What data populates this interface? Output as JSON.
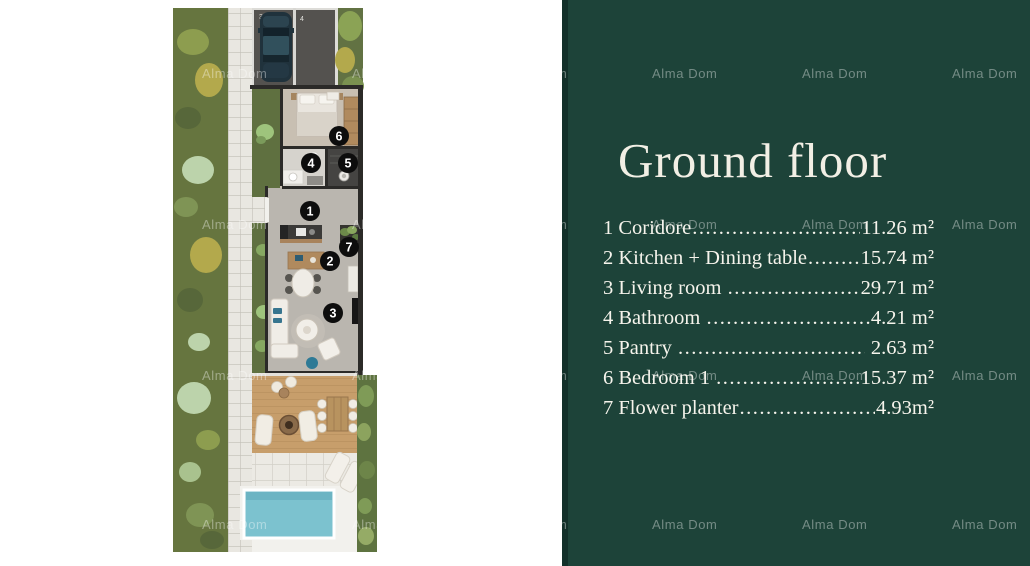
{
  "watermark": {
    "text": "Alma Dom"
  },
  "panel": {
    "title": "Ground floor",
    "leader_dots": "................................................................................",
    "items": [
      {
        "name": "1 Coridore",
        "value": "11.26 m²"
      },
      {
        "name": "2 Kitchen + Dining table",
        "value": "15.74 m²"
      },
      {
        "name": "3 Living room ",
        "value": "29.71 m²"
      },
      {
        "name": "4 Bathroom ",
        "value": "4.21 m²"
      },
      {
        "name": "5 Pantry ",
        "value": " 2.63 m²"
      },
      {
        "name": "6 Bedroom 1 ",
        "value": "15.37 m²"
      },
      {
        "name": "7 Flower planter",
        "value": "4.93m²"
      }
    ],
    "colors": {
      "background": "#1d4339",
      "edge": "#13302a",
      "text": "#f6f4ec"
    }
  },
  "floorplan": {
    "markers": [
      "1",
      "2",
      "3",
      "4",
      "5",
      "6",
      "7"
    ],
    "parking_labels": [
      "3",
      "4"
    ],
    "colors": {
      "garden": "#66753f",
      "pool": "#7cc2cf",
      "deck": "#c79e6b",
      "walkway": "#e9e7e1",
      "asphalt": "#54524f",
      "marker": "#0d0d0d"
    }
  }
}
